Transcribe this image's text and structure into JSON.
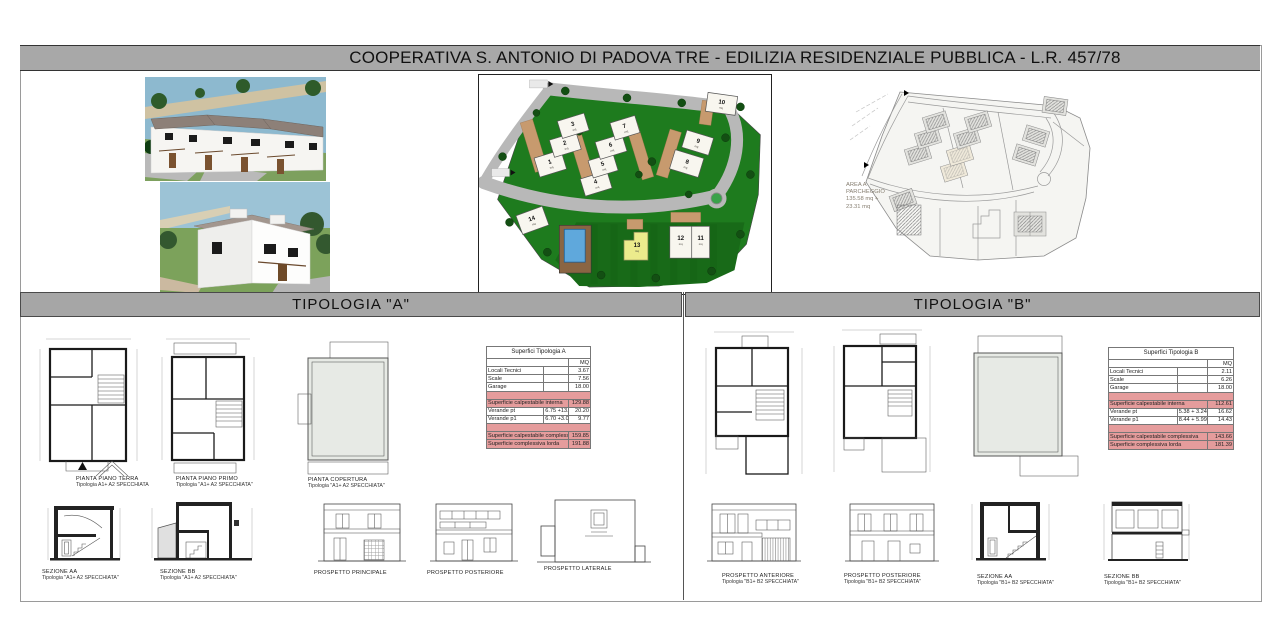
{
  "title": "COOPERATIVA S. ANTONIO DI PADOVA TRE - EDILIZIA RESIDENZIALE PUBBLICA  - L.R. 457/78",
  "sections": {
    "a": "TIPOLOGIA  \"A\"",
    "b": "TIPOLOGIA  \"B\""
  },
  "site_plan": {
    "lots": [
      {
        "number": "1",
        "area": "mq"
      },
      {
        "number": "2",
        "area": "mq"
      },
      {
        "number": "3",
        "area": "mq"
      },
      {
        "number": "4",
        "area": "mq"
      },
      {
        "number": "5",
        "area": "mq"
      },
      {
        "number": "6",
        "area": "mq"
      },
      {
        "number": "7",
        "area": "mq"
      },
      {
        "number": "8",
        "area": "mq"
      },
      {
        "number": "9",
        "area": "mq"
      },
      {
        "number": "10",
        "area": "mq"
      },
      {
        "number": "11",
        "area": "mq"
      },
      {
        "number": "12",
        "area": "mq"
      },
      {
        "number": "13",
        "area": "mq"
      },
      {
        "number": "14",
        "area": "mq"
      }
    ],
    "parking_label": [
      "AREA A",
      "PARCHEGGIO",
      "135.58 mq +",
      "23.31 mq"
    ]
  },
  "tables": {
    "a": {
      "title": "Superfici Tipologia A",
      "unit": "MQ",
      "rows": [
        {
          "label": "Locali Tecnici",
          "calc": "",
          "value": "3.67",
          "type": "normal"
        },
        {
          "label": "Scale",
          "calc": "",
          "value": "7.56",
          "type": "normal"
        },
        {
          "label": "Garage",
          "calc": "",
          "value": "18.00",
          "type": "normal"
        },
        {
          "type": "spacer"
        },
        {
          "label": "Superficie calpestabile interna",
          "calc": "",
          "value": "129.88",
          "type": "highlight"
        },
        {
          "label": "Verande pt",
          "calc": "6.75 +13.45",
          "value": "20.20",
          "type": "normal"
        },
        {
          "label": "Verande p1",
          "calc": "6.70 +3.07",
          "value": "9.77",
          "type": "normal"
        },
        {
          "type": "spacer"
        },
        {
          "label": "Superficie calpestabile complessiva",
          "calc": "",
          "value": "159.85",
          "type": "highlight"
        },
        {
          "label": "Superficie complessiva lorda",
          "calc": "",
          "value": "191.88",
          "type": "highlight"
        }
      ]
    },
    "b": {
      "title": "Superfici Tipologia B",
      "unit": "MQ",
      "rows": [
        {
          "label": "Locali Tecnici",
          "calc": "",
          "value": "2.11",
          "type": "normal"
        },
        {
          "label": "Scale",
          "calc": "",
          "value": "6.26",
          "type": "normal"
        },
        {
          "label": "Garage",
          "calc": "",
          "value": "18.00",
          "type": "normal"
        },
        {
          "type": "spacer"
        },
        {
          "label": "Superficie calpestabile interna",
          "calc": "",
          "value": "112.61",
          "type": "highlight"
        },
        {
          "label": "Verande pt",
          "calc": "5.38 + 3.24 + 6.00",
          "value": "16.62",
          "type": "normal"
        },
        {
          "label": "Verande p1",
          "calc": "8.44 + 5.99",
          "value": "14.43",
          "type": "normal"
        },
        {
          "type": "spacer"
        },
        {
          "label": "Superficie calpestabile complessiva",
          "calc": "",
          "value": "143.66",
          "type": "highlight"
        },
        {
          "label": "Superficie complessiva lorda",
          "calc": "",
          "value": "181.39",
          "type": "highlight"
        }
      ]
    }
  },
  "captions": {
    "a_top": [
      {
        "title": "PIANTA PIANO TERRA",
        "sub": "Tipologia A1+ A2 SPECCHIATA"
      },
      {
        "title": "PIANTA PIANO PRIMO",
        "sub": "Tipologia \"A1+ A2 SPECCHIATA\""
      },
      {
        "title": "PIANTA COPERTURA",
        "sub": "Tipologia \"A1+ A2 SPECCHIATA\""
      }
    ],
    "a_bottom": [
      {
        "title": "SEZIONE AA",
        "sub": "Tipologia \"A1+ A2 SPECCHIATA\""
      },
      {
        "title": "SEZIONE BB",
        "sub": "Tipologia \"A1+ A2 SPECCHIATA\""
      },
      {
        "title": "PROSPETTO PRINCIPALE",
        "sub": ""
      },
      {
        "title": "PROSPETTO POSTERIORE",
        "sub": ""
      },
      {
        "title": "PROSPETTO LATERALE",
        "sub": ""
      }
    ],
    "b_bottom": [
      {
        "title": "PROSPETTO ANTERIORE",
        "sub": "Tipologia \"B1+ B2 SPECCHIATA\""
      },
      {
        "title": "PROSPETTO POSTERIORE",
        "sub": "Tipologia \"B1+ B2 SPECCHIATA\""
      },
      {
        "title": "SEZIONE AA",
        "sub": "Tipologia \"B1+ B2 SPECCHIATA\""
      },
      {
        "title": "SEZIONE BB",
        "sub": "Tipologia \"B1+ B2 SPECCHIATA\""
      }
    ]
  },
  "colors": {
    "header_gray": "#a8a8a8",
    "site_green": "#1e7b1e",
    "road_gray": "#b8b8b8",
    "lot_yellow": "#eceb8c",
    "pool_blue": "#5fa8dc",
    "table_highlight": "#e59c9c"
  }
}
